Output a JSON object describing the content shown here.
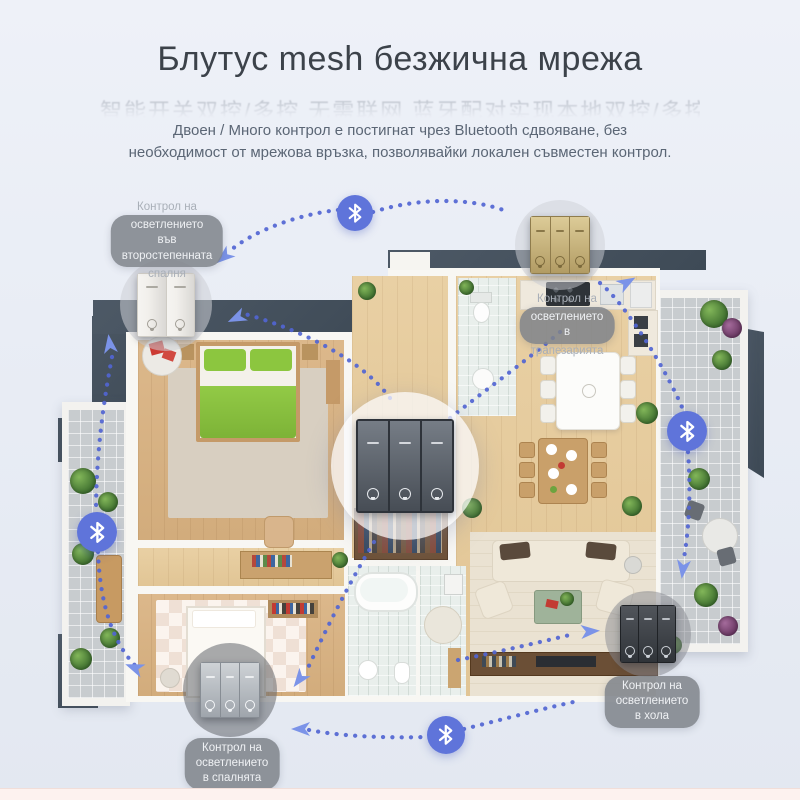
{
  "header": {
    "title": "Блутус mesh безжична мрежа",
    "faded_overlay_text": "智能开关双控/多控 无需联网 蓝牙配对实现本地双控/多控联动",
    "subtitle_line1": "Двоен / Много контрол е постигнат чрез Bluetooth сдвояване, без",
    "subtitle_line2": "необходимост от мрежова връзка, позволявайки локален съвместен контрол."
  },
  "colors": {
    "bluetooth_blue": "#5f74da",
    "dot_blue": "#5165d2",
    "arrow_blue": "#7b93e8",
    "roof_slate": "#46525e",
    "label_pill_gray": "#7f838a",
    "title_text": "#3c424a",
    "subtitle_text": "#5b6675",
    "accent_green": "#8cc63f"
  },
  "bluetooth_nodes": [
    {
      "x": 355,
      "y": 213,
      "r": 18
    },
    {
      "x": 687,
      "y": 431,
      "r": 20
    },
    {
      "x": 97,
      "y": 532,
      "r": 20
    },
    {
      "x": 446,
      "y": 735,
      "r": 19
    }
  ],
  "switches": [
    {
      "id": "secondary-bedroom",
      "style": "white",
      "gangs": 2,
      "cx": 166,
      "cy": 305,
      "r": 46,
      "w": 56,
      "h": 62
    },
    {
      "id": "dining",
      "style": "gold",
      "gangs": 3,
      "cx": 560,
      "cy": 245,
      "r": 45,
      "w": 58,
      "h": 56
    },
    {
      "id": "mesh-hub",
      "style": "dark",
      "gangs": 3,
      "cx": 405,
      "cy": 466,
      "r": 74,
      "w": 94,
      "h": 90
    },
    {
      "id": "bedroom",
      "style": "silver",
      "gangs": 3,
      "cx": 230,
      "cy": 690,
      "r": 47,
      "w": 58,
      "h": 54
    },
    {
      "id": "living-room",
      "style": "black",
      "gangs": 3,
      "cx": 648,
      "cy": 634,
      "r": 43,
      "w": 54,
      "h": 56
    }
  ],
  "labels": [
    {
      "id": "secondary-bedroom",
      "cx": 167,
      "top": 200,
      "above": "Контрол на",
      "pill": [
        "осветлението",
        "във",
        "второстепенната"
      ],
      "below": "спалня"
    },
    {
      "id": "dining",
      "cx": 567,
      "top": 292,
      "above": "Контрол на",
      "pill": [
        "осветлението",
        "в"
      ],
      "below": "трапезарията"
    },
    {
      "id": "living-room",
      "cx": 652,
      "top": 676,
      "above": "",
      "pill": [
        "Контрол на",
        "осветлението",
        "в хола"
      ],
      "below": ""
    },
    {
      "id": "bedroom",
      "cx": 232,
      "top": 738,
      "above": "",
      "pill": [
        "Контрол на",
        "осветлението",
        "в спалнята"
      ],
      "below": ""
    }
  ],
  "links": [
    "M338,210 C300,214 255,230 231,250",
    "M373,212 C420,197 472,198 506,211",
    "M600,283 C625,303 668,372 684,412",
    "M688,452 C691,492 689,528 684,558",
    "M112,357 C100,420 96,470 96,513",
    "M98,552 C100,606 114,648 141,671",
    "M309,730 C345,737 392,738 427,737",
    "M464,729 C500,720 545,708 578,701",
    "M560,332 C525,362 472,400 444,423",
    "M390,398 C362,360 302,330 245,314",
    "M374,542 C345,590 322,638 307,670",
    "M458,660 C498,652 540,642 574,634"
  ],
  "arrows": [
    {
      "x": 231,
      "y": 251,
      "rot": 140
    },
    {
      "x": 245,
      "y": 314,
      "rot": 155
    },
    {
      "x": 619,
      "y": 287,
      "rot": -30
    },
    {
      "x": 684,
      "y": 560,
      "rot": 97
    },
    {
      "x": 111,
      "y": 353,
      "rot": -98
    },
    {
      "x": 143,
      "y": 671,
      "rot": 201
    },
    {
      "x": 310,
      "y": 729,
      "rot": 180
    },
    {
      "x": 305,
      "y": 672,
      "rot": 127
    },
    {
      "x": 581,
      "y": 632,
      "rot": -4
    }
  ]
}
